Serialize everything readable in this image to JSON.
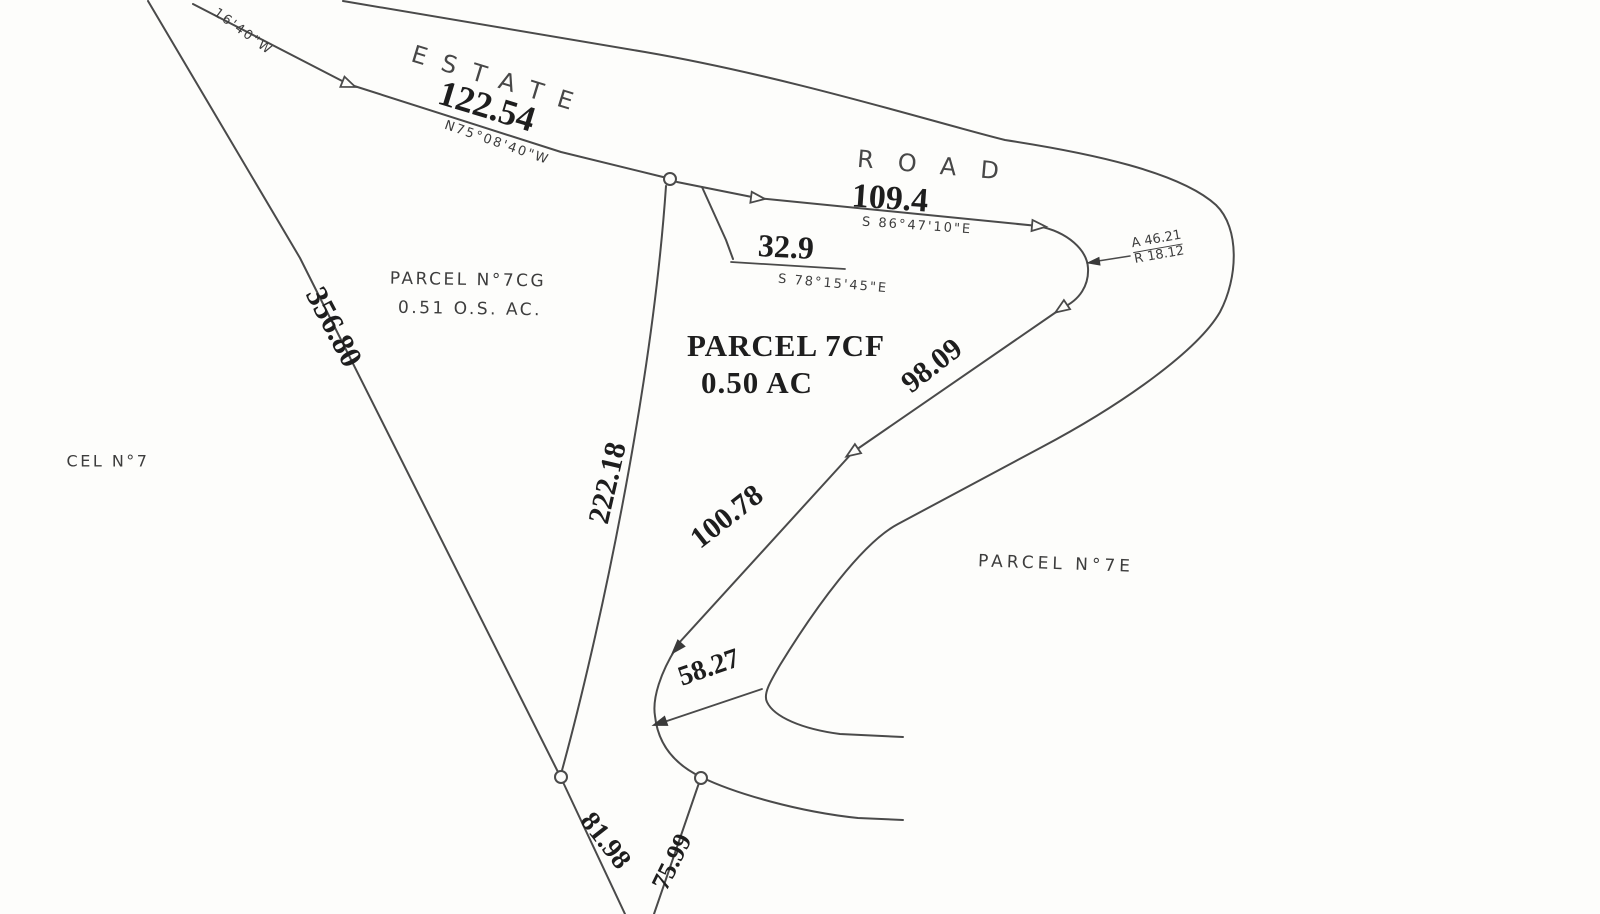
{
  "map": {
    "road": {
      "name_upper": "ESTATE",
      "name_lower": "ROAD"
    },
    "parcels": {
      "p7cg": {
        "name": "PARCEL N°7CG",
        "area": "0.51 O.S. AC."
      },
      "p7cf": {
        "name": "PARCEL 7CF",
        "area": "0.50 AC"
      },
      "p7e": {
        "name": "PARCEL N°7E"
      },
      "p7": {
        "name_partial": "CEL N°7"
      }
    },
    "dimensions": {
      "seg_122_54": {
        "length": "122.54",
        "bearing": "N75°08'40\"W"
      },
      "seg_109_4": {
        "length": "109.4",
        "bearing": "S 86°47'10\"E"
      },
      "seg_32_9": {
        "length": "32.9",
        "bearing": "S 78°15'45\"E"
      },
      "seg_98_09": {
        "length": "98.09"
      },
      "seg_100_78": {
        "length": "100.78"
      },
      "seg_222_18": {
        "length": "222.18"
      },
      "seg_356_80": {
        "length": "356.80"
      },
      "seg_58_27": {
        "length": "58.27"
      },
      "seg_81_98": {
        "length": "81.98"
      },
      "seg_75_99": {
        "length": "75.99"
      },
      "bearing_partial_top_left": "16'40\"W"
    },
    "curve_note": {
      "arc": "A 46.21",
      "radius": "R 18.12"
    }
  }
}
